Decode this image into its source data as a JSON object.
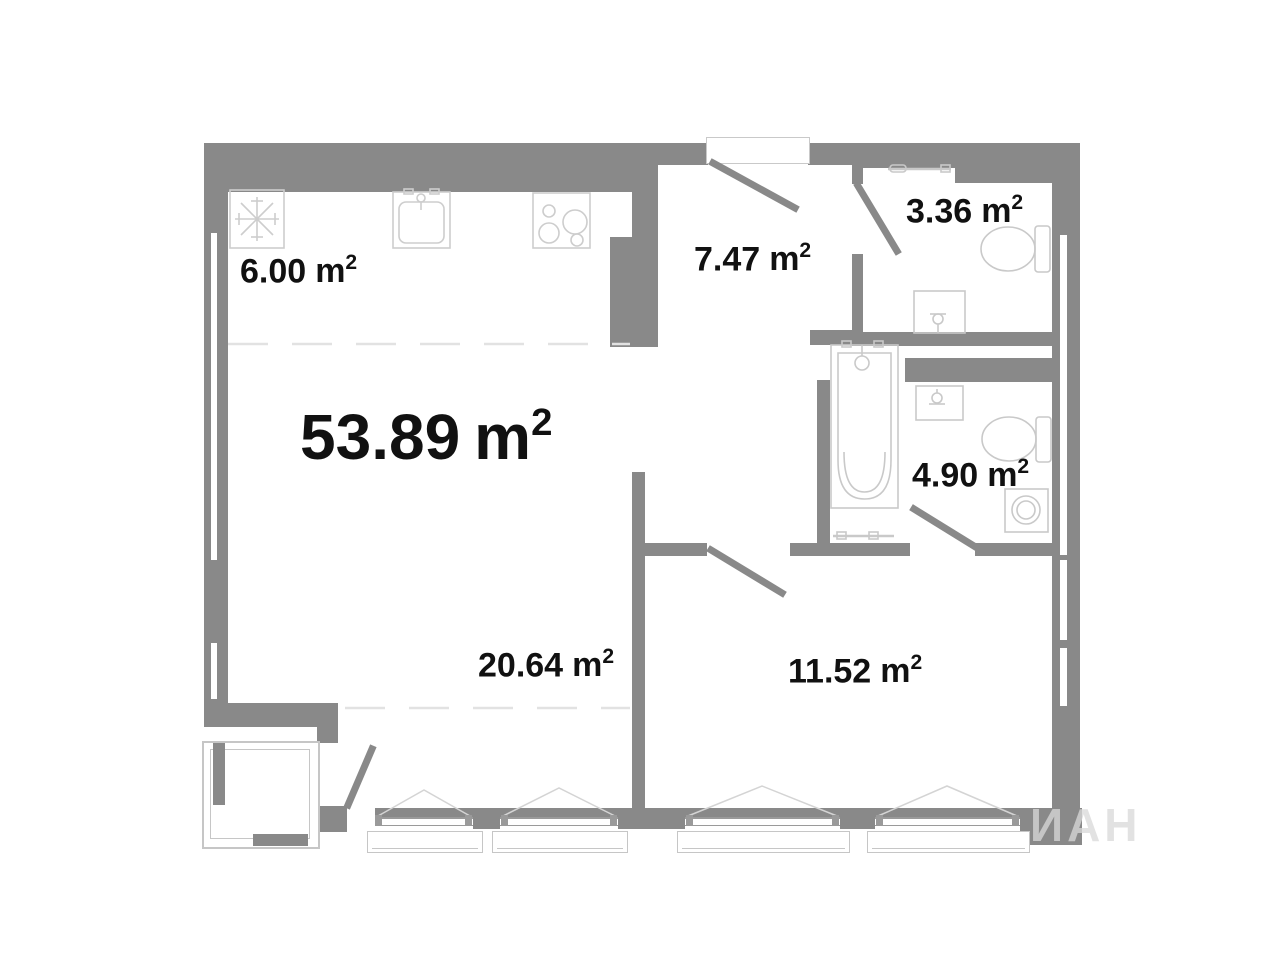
{
  "document": {
    "type": "apartment-floor-plan",
    "language": "ru"
  },
  "units": {
    "base": "m",
    "sup": "2"
  },
  "areas": {
    "total": "53.89",
    "kitchen": "6.00",
    "hallway": "7.47",
    "bathroom_small": "3.36",
    "bathroom_large": "4.90",
    "living_zone": "20.64",
    "bedroom": "11.52"
  },
  "watermark": "ИАН",
  "fixtures": [
    "fridge-icon",
    "kitchen-sink-icon",
    "stove-icon",
    "toilet-icon",
    "toilet-icon",
    "washbasin-icon",
    "washbasin-icon",
    "bathtub-icon",
    "washing-machine-icon",
    "towel-rail-icon",
    "towel-rail-icon"
  ],
  "colors": {
    "wall": "#898989",
    "frame": "#9a9a9a",
    "fixture": "#c9c9c9",
    "sill": "#c6c6c6",
    "dashed": "#e2e2e2",
    "label": "#111111",
    "watermark": "#d9d9d9"
  }
}
